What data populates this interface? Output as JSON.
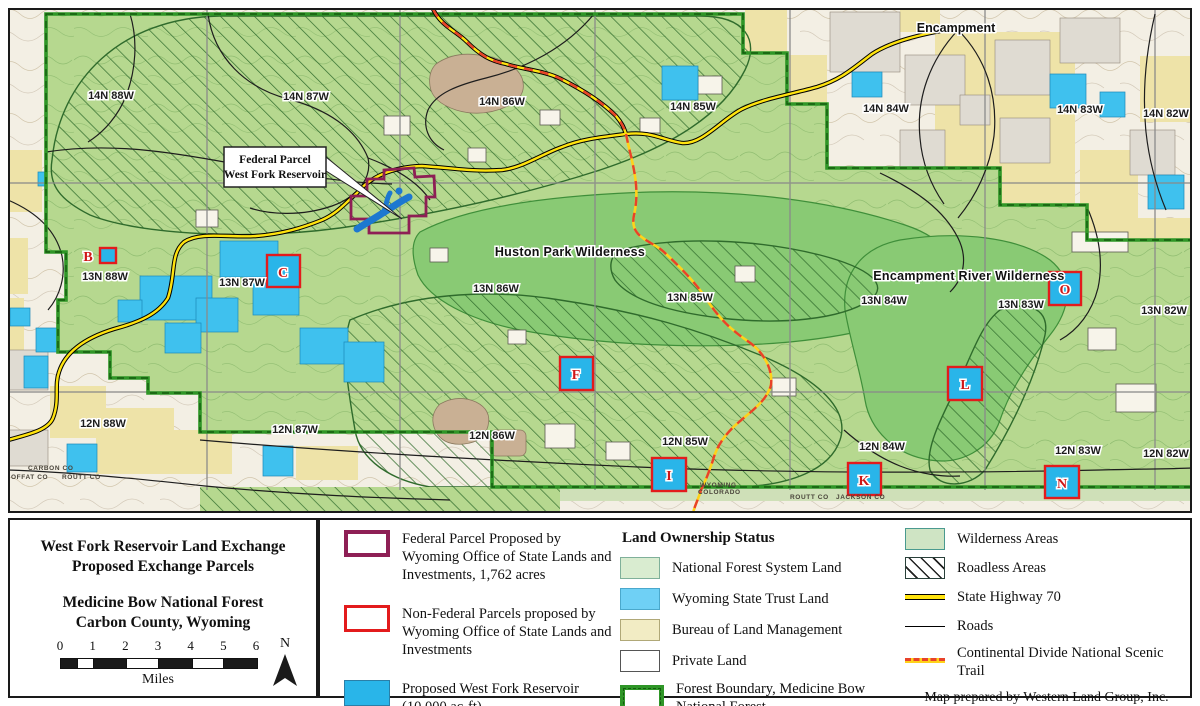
{
  "colors": {
    "forest_green": "#b6d88f",
    "wilderness_green": "#89ca74",
    "boundary_green": "#2f9627",
    "boundary_dark": "#155c0f",
    "state_blue": "#3fc1ee",
    "reservoir_blue": "#29b5e9",
    "deep_blue": "#1d78d0",
    "blm_yellow": "#eee3a8",
    "highway_yellow": "#ffe30e",
    "trail_red": "#e8422a",
    "federal_maroon": "#8e1f55",
    "parcel_red": "#e31b1c",
    "grid_gray": "#8a8a8a"
  },
  "map": {
    "townships": [
      {
        "text": "14N 88W",
        "x": 111,
        "y": 99
      },
      {
        "text": "14N 87W",
        "x": 306,
        "y": 100
      },
      {
        "text": "14N 86W",
        "x": 502,
        "y": 105
      },
      {
        "text": "14N 85W",
        "x": 693,
        "y": 110
      },
      {
        "text": "14N 84W",
        "x": 886,
        "y": 112
      },
      {
        "text": "14N 83W",
        "x": 1080,
        "y": 113
      },
      {
        "text": "14N 82W",
        "x": 1166,
        "y": 117
      },
      {
        "text": "13N 88W",
        "x": 105,
        "y": 280
      },
      {
        "text": "13N 87W",
        "x": 242,
        "y": 286
      },
      {
        "text": "13N 86W",
        "x": 496,
        "y": 292
      },
      {
        "text": "13N 85W",
        "x": 690,
        "y": 301
      },
      {
        "text": "13N 84W",
        "x": 884,
        "y": 304
      },
      {
        "text": "13N 83W",
        "x": 1021,
        "y": 308
      },
      {
        "text": "13N 82W",
        "x": 1164,
        "y": 314
      },
      {
        "text": "12N 88W",
        "x": 103,
        "y": 427
      },
      {
        "text": "12N 87W",
        "x": 295,
        "y": 433
      },
      {
        "text": "12N 86W",
        "x": 492,
        "y": 439
      },
      {
        "text": "12N 85W",
        "x": 685,
        "y": 445
      },
      {
        "text": "12N 84W",
        "x": 882,
        "y": 450
      },
      {
        "text": "12N 83W",
        "x": 1078,
        "y": 454
      },
      {
        "text": "12N 82W",
        "x": 1166,
        "y": 457
      }
    ],
    "wilderness_labels": [
      {
        "text": "Huston Park Wilderness",
        "x": 570,
        "y": 256
      },
      {
        "text": "Encampment River Wilderness",
        "x": 969,
        "y": 280
      }
    ],
    "town_labels": [
      {
        "text": "Encampment",
        "x": 956,
        "y": 32
      }
    ],
    "county_labels": [
      {
        "text": "CARBON  CO",
        "x": 28,
        "y": 470
      },
      {
        "text": "MOFFAT  CO",
        "x": 5,
        "y": 479
      },
      {
        "text": "ROUTT  CO",
        "x": 62,
        "y": 479
      },
      {
        "text": "WYOMING",
        "x": 700,
        "y": 487
      },
      {
        "text": "COLORADO",
        "x": 698,
        "y": 494
      },
      {
        "text": "ROUTT  CO",
        "x": 790,
        "y": 499
      },
      {
        "text": "JACKSON  CO",
        "x": 836,
        "y": 499
      }
    ],
    "callout": {
      "line1": "Federal Parcel",
      "line2": "West Fork Reservoir"
    },
    "parcels": [
      {
        "letter": "B",
        "box": [
          100,
          248,
          16,
          15
        ],
        "label": [
          88,
          261
        ]
      },
      {
        "letter": "C",
        "box": [
          267,
          255,
          33,
          32
        ],
        "label": [
          283,
          277
        ]
      },
      {
        "letter": "F",
        "box": [
          560,
          357,
          33,
          33
        ],
        "label": [
          576,
          379
        ]
      },
      {
        "letter": "I",
        "box": [
          652,
          458,
          34,
          33
        ],
        "label": [
          669,
          480
        ]
      },
      {
        "letter": "K",
        "box": [
          848,
          463,
          33,
          32
        ],
        "label": [
          864,
          485
        ]
      },
      {
        "letter": "L",
        "box": [
          948,
          367,
          34,
          33
        ],
        "label": [
          965,
          389
        ]
      },
      {
        "letter": "N",
        "box": [
          1045,
          466,
          34,
          32
        ],
        "label": [
          1062,
          488
        ]
      },
      {
        "letter": "O",
        "box": [
          1049,
          272,
          32,
          33
        ],
        "label": [
          1065,
          294
        ]
      }
    ]
  },
  "title_block": {
    "lines": [
      "West Fork Reservoir Land Exchange",
      "Proposed Exchange Parcels",
      "Medicine Bow National Forest",
      "Carbon County, Wyoming"
    ],
    "scale": {
      "ticks": [
        "0",
        "1",
        "2",
        "3",
        "4",
        "5",
        "6"
      ],
      "unit": "Miles",
      "total_miles": 6,
      "segments": [
        [
          0,
          0.5,
          "dark"
        ],
        [
          0.5,
          1,
          "light"
        ],
        [
          1,
          2,
          "dark"
        ],
        [
          2,
          3,
          "light"
        ],
        [
          3,
          4,
          "dark"
        ],
        [
          4,
          5,
          "light"
        ],
        [
          5,
          6,
          "dark"
        ]
      ]
    },
    "north_label": "N"
  },
  "legend": {
    "parcel_items": [
      {
        "swatch": "federal",
        "label": "Federal Parcel Proposed by Wyoming Office of State Lands and Investments, 1,762 acres"
      },
      {
        "swatch": "nonfederal",
        "label": "Non-Federal Parcels proposed by Wyoming Office of State Lands and Investments"
      },
      {
        "swatch": "reservoir",
        "label": "Proposed West Fork Reservoir (10,000 ac-ft)"
      }
    ],
    "ownership": {
      "heading": "Land Ownership Status",
      "items": [
        {
          "swatch": "nfs",
          "label": "National Forest System Land"
        },
        {
          "swatch": "state",
          "label": "Wyoming State Trust Land"
        },
        {
          "swatch": "blm",
          "label": "Bureau of Land Management"
        },
        {
          "swatch": "private",
          "label": "Private Land"
        },
        {
          "swatch": "boundary",
          "label": "Forest Boundary, Medicine Bow National Forest"
        }
      ]
    },
    "features": {
      "items": [
        {
          "swatch": "wilderness",
          "label": "Wilderness Areas"
        },
        {
          "swatch": "roadless",
          "label": "Roadless Areas"
        },
        {
          "swatch": "highway",
          "label": "State Highway 70"
        },
        {
          "swatch": "road",
          "label": "Roads"
        },
        {
          "swatch": "trail",
          "label": "Continental Divide National Scenic Trail"
        }
      ],
      "credit_line1": "Map prepared by Western Land Group, Inc.",
      "credit_line2": "9/23/2022"
    }
  }
}
